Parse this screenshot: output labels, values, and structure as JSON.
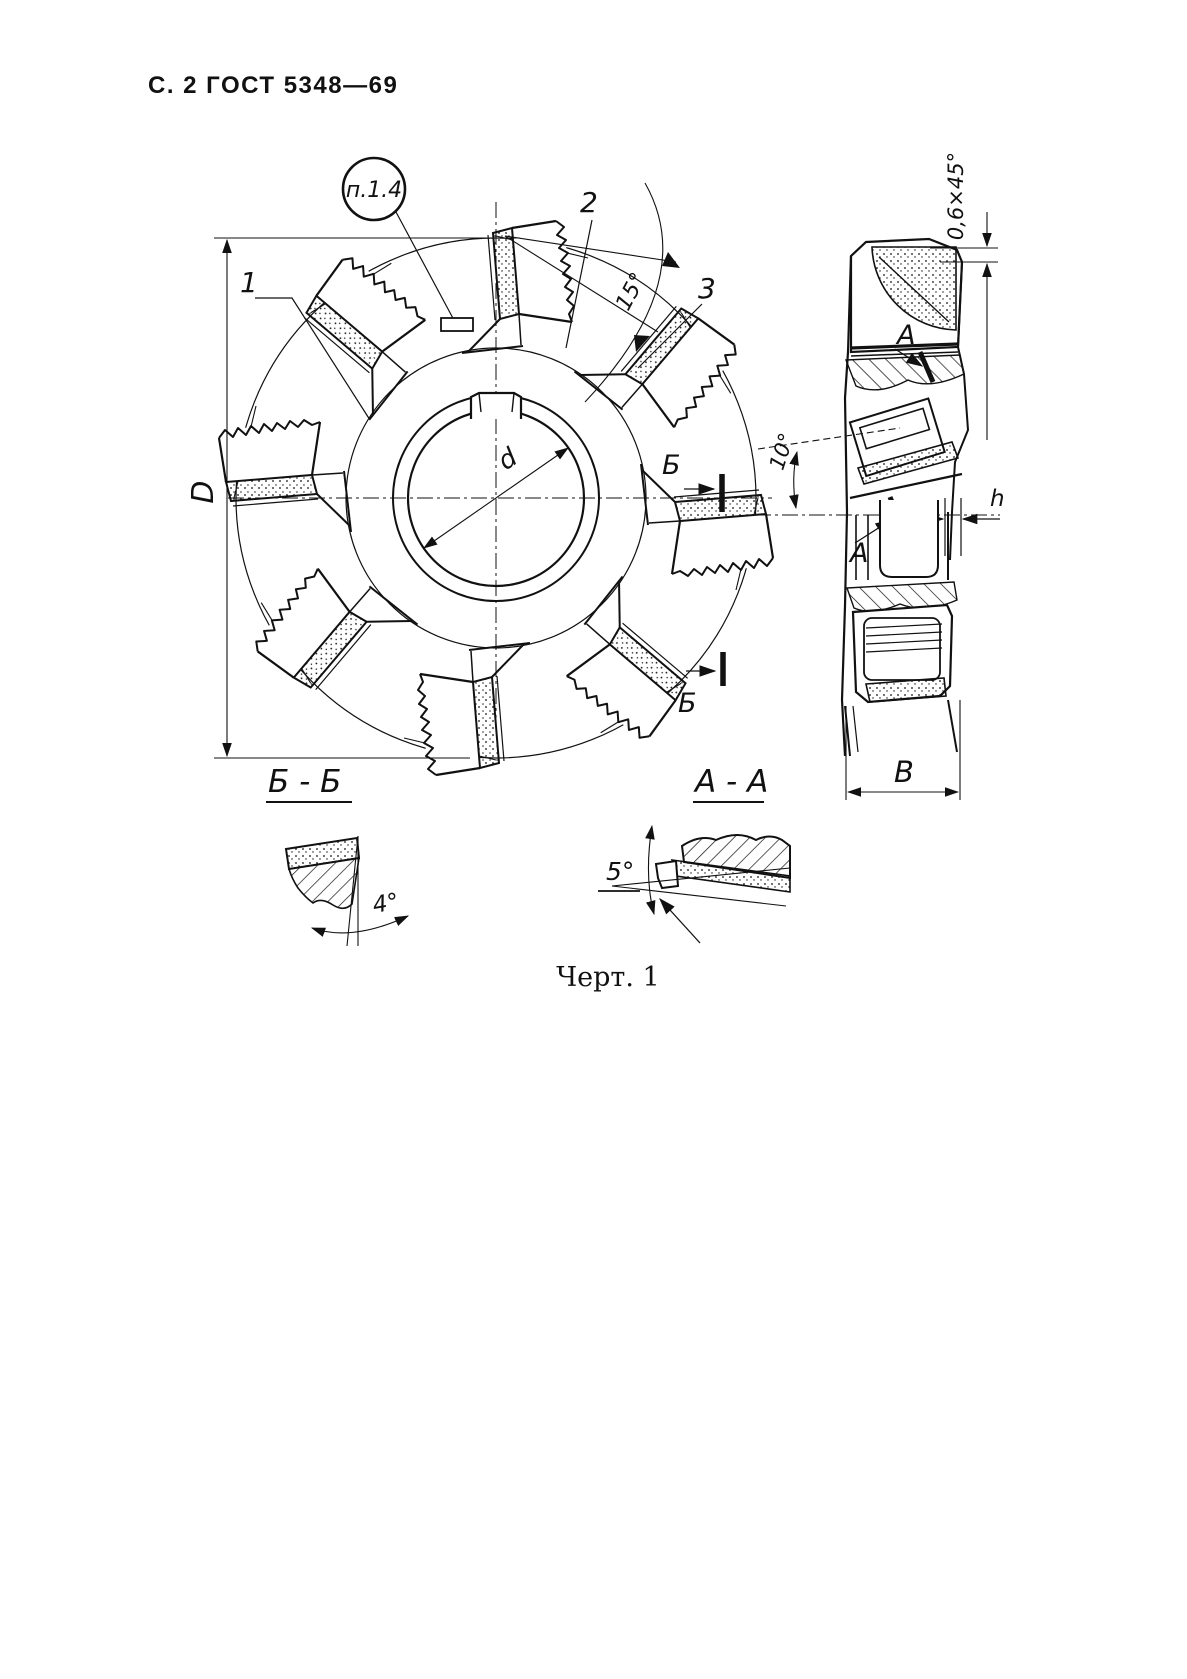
{
  "page": {
    "header": "С. 2 ГОСТ 5348—69",
    "caption": "Черт. 1"
  },
  "front_view": {
    "callout_label": "п.1.4",
    "item_1": "1",
    "item_2": "2",
    "item_3": "3",
    "angle_15": "15°",
    "dim_outer_diameter": "D",
    "dim_bore_diameter": "d",
    "section_B_upper": "Б",
    "section_B_lower": "Б"
  },
  "side_view": {
    "chamfer_dim": "0,6×45°",
    "face_label_A": "А",
    "angle_10": "10°",
    "plane_label_A": "А",
    "dim_h": "h",
    "dim_B": "В"
  },
  "section_BB": {
    "title": "Б - Б",
    "angle_4": "4°"
  },
  "section_AA": {
    "title": "А - А",
    "angle_5": "5°"
  }
}
